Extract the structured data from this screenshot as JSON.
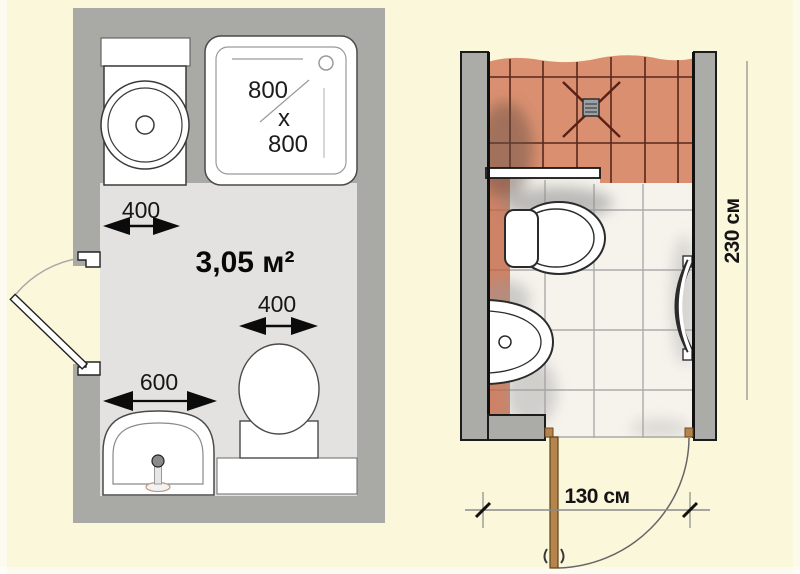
{
  "colors": {
    "background": "#FBF7DB",
    "wall_grey": "#A9AAA5",
    "wall_grey_right": "#ABACA8",
    "floor_grey": "#E3E2E0",
    "fixture_white": "#FFFFFF",
    "tile_terracotta": "#DA9070",
    "tile_terracotta_wall": "#CE8266",
    "grout_dark": "#57281B",
    "floor_tile_ivory": "#F6F3ED",
    "tile_line_grey": "#ABABAB",
    "door_wood_brown": "#B5854D",
    "dim_text": "#1A1A1A"
  },
  "left_plan": {
    "area_label": "3,05 м²",
    "shower_label": [
      "800",
      "x",
      "800"
    ],
    "dims": {
      "washer_clearance": "400",
      "toilet_width": "400",
      "basin_width": "600"
    }
  },
  "right_plan": {
    "dims": {
      "room_depth": "230 см",
      "door_width": "130 см"
    }
  }
}
